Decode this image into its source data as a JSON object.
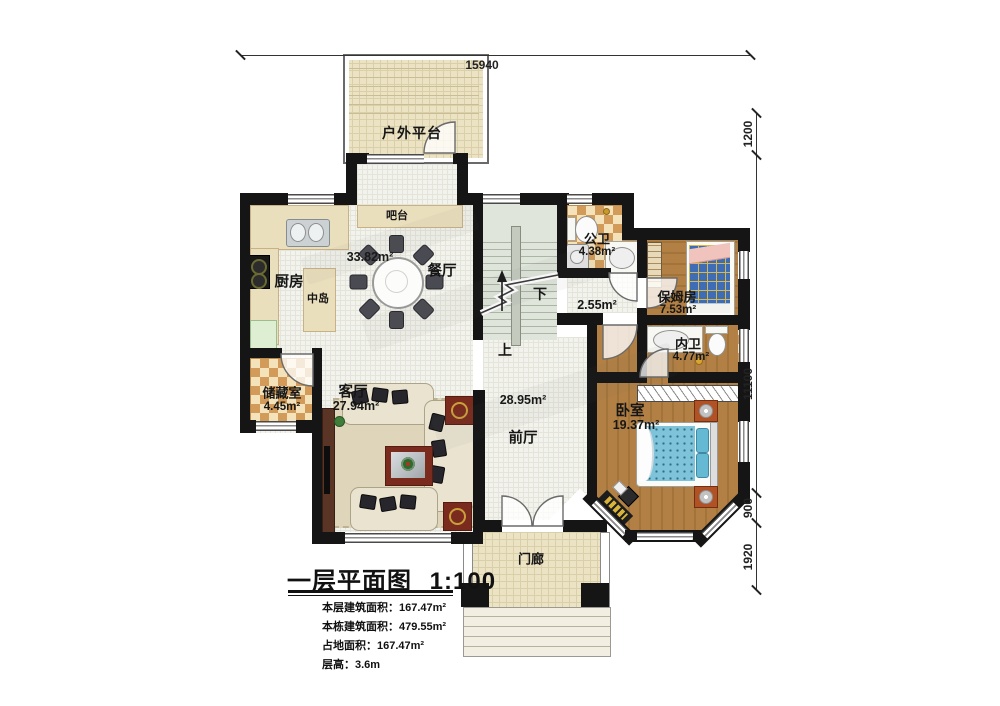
{
  "title": {
    "name": "一层平面图",
    "scale": "1:100"
  },
  "info_rows": [
    {
      "label": "本层建筑面积：",
      "value": "167.47m²"
    },
    {
      "label": "本栋建筑面积：",
      "value": "479.55m²"
    },
    {
      "label": "占地面积：",
      "value": "167.47m²"
    },
    {
      "label": "层高：",
      "value": "3.6m"
    }
  ],
  "dimensions": {
    "top": "15940",
    "right_top": "1200",
    "right_main": "11100",
    "right_bay": "900",
    "right_porch": "1920"
  },
  "rooms": {
    "platform": {
      "name": "户外平台"
    },
    "bar": {
      "name": "吧台"
    },
    "kitchen": {
      "name": "厨房",
      "area": "33.82m²"
    },
    "island": {
      "name": "中岛"
    },
    "dining": {
      "name": "餐厅"
    },
    "public_bath": {
      "name": "公卫",
      "area": "4.38m²"
    },
    "corridor": {
      "area": "2.55m²"
    },
    "nanny": {
      "name": "保姆房",
      "area": "7.53m²"
    },
    "inner_bath": {
      "name": "内卫",
      "area": "4.77m²"
    },
    "storage": {
      "name": "储藏室",
      "area": "4.45m²"
    },
    "living": {
      "name": "客厅",
      "area": "27.94m²"
    },
    "front_hall": {
      "name": "前厅",
      "area": "28.95m²"
    },
    "bedroom": {
      "name": "卧室",
      "area": "19.37m²"
    },
    "porch": {
      "name": "门廊"
    }
  },
  "stairs": {
    "up": "上",
    "down": "下"
  },
  "colors": {
    "wall": "#151515",
    "checker_dark": "#d29b59",
    "checker_light": "#f3e2ba",
    "wood": "#b28044",
    "outdoor_tile": "#ebe3c4",
    "bed_blue": "#3f6db5",
    "bed_cyan": "#7ec3d9",
    "accent_red": "#7a2b1e"
  }
}
